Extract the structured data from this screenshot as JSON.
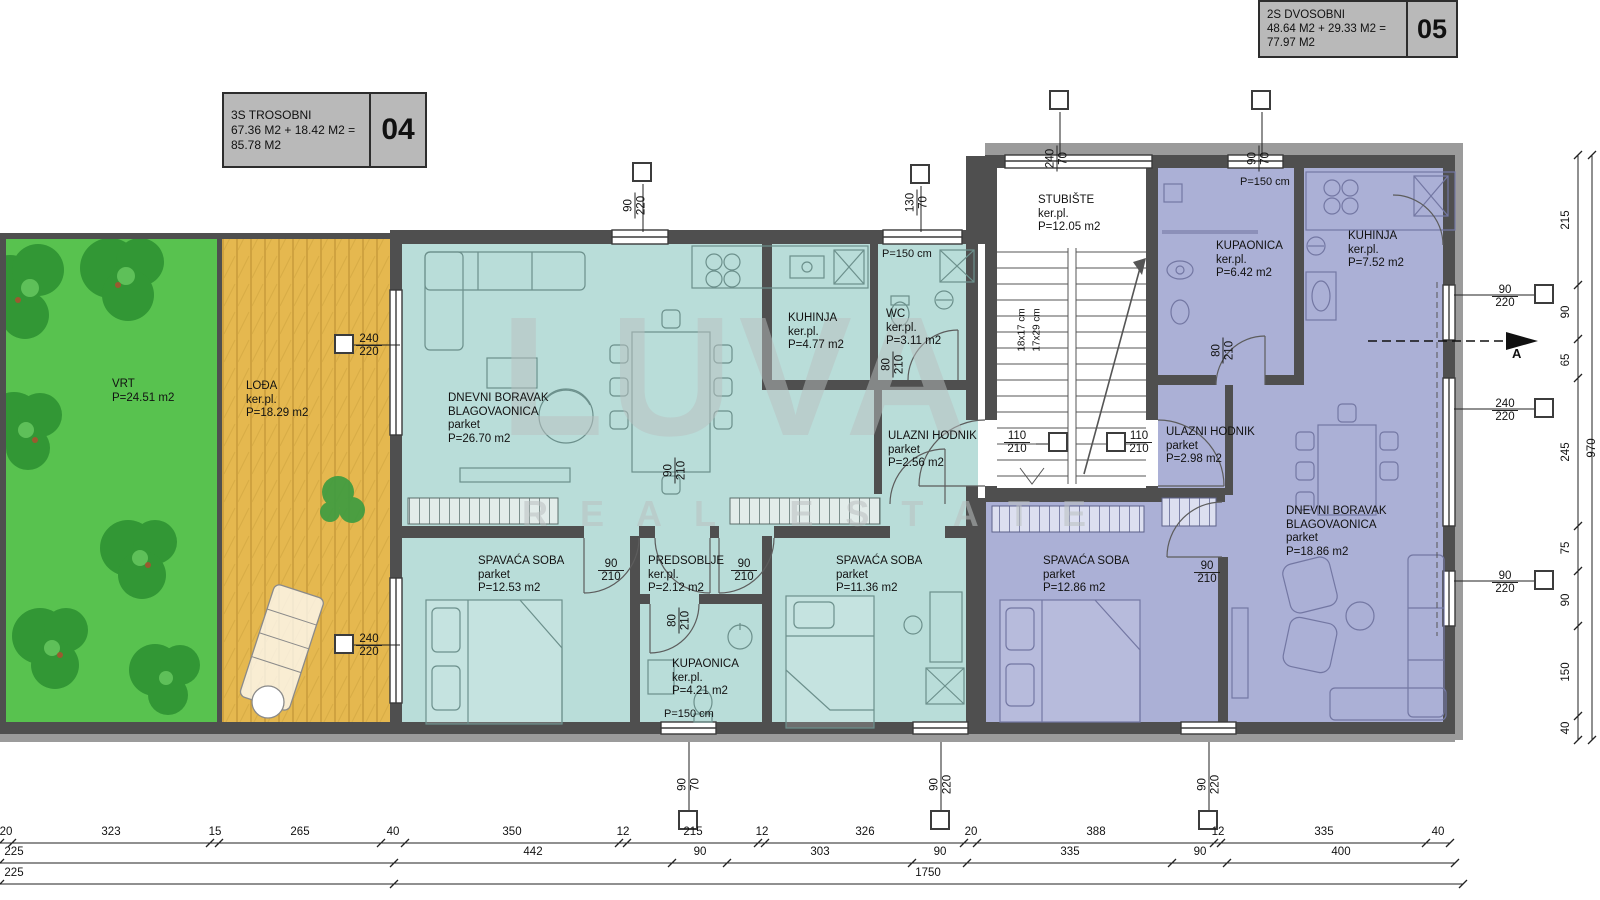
{
  "header": {
    "apt04": {
      "type": "3S TROSOBNI",
      "calc": "67.36 M2 + 18.42 M2 =",
      "total": "85.78 M2",
      "num": "04"
    },
    "apt05": {
      "type": "2S DVOSOBNI",
      "calc": "48.64 M2 + 29.33 M2 =",
      "total": "77.97 M2",
      "num": "05"
    }
  },
  "rooms": {
    "vrt": {
      "name": "VRT",
      "area": "P=24.51 m2"
    },
    "lodja": {
      "name": "LOĐA",
      "floor": "ker.pl.",
      "area": "P=18.29 m2"
    },
    "dnevni04": {
      "name": "DNEVNI BORAVAK",
      "name2": "BLAGOVAONICA",
      "floor": "parket",
      "area": "P=26.70 m2"
    },
    "kuhinja04": {
      "name": "KUHINJA",
      "floor": "ker.pl.",
      "area": "P=4.77 m2"
    },
    "wc04": {
      "name": "WC",
      "floor": "ker.pl.",
      "area": "P=3.11 m2"
    },
    "ulazni04": {
      "name": "ULAZNI HODNIK",
      "floor": "parket",
      "area": "P=2.56 m2"
    },
    "spavaca1": {
      "name": "SPAVAĆA SOBA",
      "floor": "parket",
      "area": "P=12.53 m2"
    },
    "predsoblje": {
      "name": "PREDSOBLJE",
      "floor": "ker.pl.",
      "area": "P=2.12 m2"
    },
    "kupaonica04": {
      "name": "KUPAONICA",
      "floor": "ker.pl.",
      "area": "P=4.21 m2"
    },
    "spavaca2": {
      "name": "SPAVAĆA SOBA",
      "floor": "parket",
      "area": "P=11.36 m2"
    },
    "stubiste": {
      "name": "STUBIŠTE",
      "floor": "ker.pl.",
      "area": "P=12.05 m2"
    },
    "kupaonica05": {
      "name": "KUPAONICA",
      "floor": "ker.pl.",
      "area": "P=6.42 m2"
    },
    "kuhinja05": {
      "name": "KUHINJA",
      "floor": "ker.pl.",
      "area": "P=7.52 m2"
    },
    "ulazni05": {
      "name": "ULAZNI HODNIK",
      "floor": "parket",
      "area": "P=2.98 m2"
    },
    "spavaca05": {
      "name": "SPAVAĆA SOBA",
      "floor": "parket",
      "area": "P=12.86 m2"
    },
    "dnevni05": {
      "name": "DNEVNI BORAVAK",
      "name2": "BLAGOVAONICA",
      "floor": "parket",
      "area": "P=18.86 m2"
    }
  },
  "notes": {
    "p150": "P=150 cm",
    "stairs1": "18x17 cm",
    "stairs2": "17x29 cm",
    "section": "A"
  },
  "pairs": {
    "l1": {
      "a": "240",
      "b": "220"
    },
    "l2": {
      "a": "240",
      "b": "220"
    },
    "t1": {
      "a": "90",
      "b": "220"
    },
    "t2": {
      "a": "130",
      "b": "70"
    },
    "t3": {
      "a": "240",
      "b": "70"
    },
    "t4": {
      "a": "90",
      "b": "70"
    },
    "r1": {
      "a": "90",
      "b": "220"
    },
    "r2": {
      "a": "240",
      "b": "220"
    },
    "r3": {
      "a": "90",
      "b": "220"
    },
    "b1": {
      "a": "90",
      "b": "70"
    },
    "b2": {
      "a": "90",
      "b": "220"
    },
    "b3": {
      "a": "90",
      "b": "220"
    },
    "d1": {
      "a": "90",
      "b": "210"
    },
    "d2": {
      "a": "90",
      "b": "210"
    },
    "d3": {
      "a": "80",
      "b": "210"
    },
    "d4": {
      "a": "90",
      "b": "210"
    },
    "d5": {
      "a": "80",
      "b": "210"
    },
    "d6a": {
      "a": "110",
      "b": "210"
    },
    "d6b": {
      "a": "110",
      "b": "210"
    },
    "d7": {
      "a": "80",
      "b": "210"
    },
    "d8": {
      "a": "90",
      "b": "210"
    }
  },
  "dims": {
    "bottom_row1": [
      "20",
      "323",
      "15",
      "265",
      "40",
      "350",
      "12",
      "215",
      "12",
      "326",
      "20",
      "388",
      "12",
      "335",
      "40"
    ],
    "bottom_row2": [
      "225",
      "442",
      "90",
      "303",
      "90",
      "335",
      "90",
      "400"
    ],
    "bottom_row3": [
      "225",
      "1750"
    ],
    "right_col": [
      "215",
      "90",
      "65",
      "245",
      "75",
      "90",
      "150",
      "40"
    ],
    "right_total": "970"
  },
  "watermark": {
    "brand": "LUVA",
    "sub": "REAL ESTATE"
  },
  "colors": {
    "teal_apartment": "#b9ddd9",
    "purple_apartment": "#abb0d6",
    "garden_green": "#58c24f",
    "loggia_orange": "#e5b84f",
    "wall_dark": "#4f4f4f",
    "title_box_bg": "#b9b9b9"
  }
}
